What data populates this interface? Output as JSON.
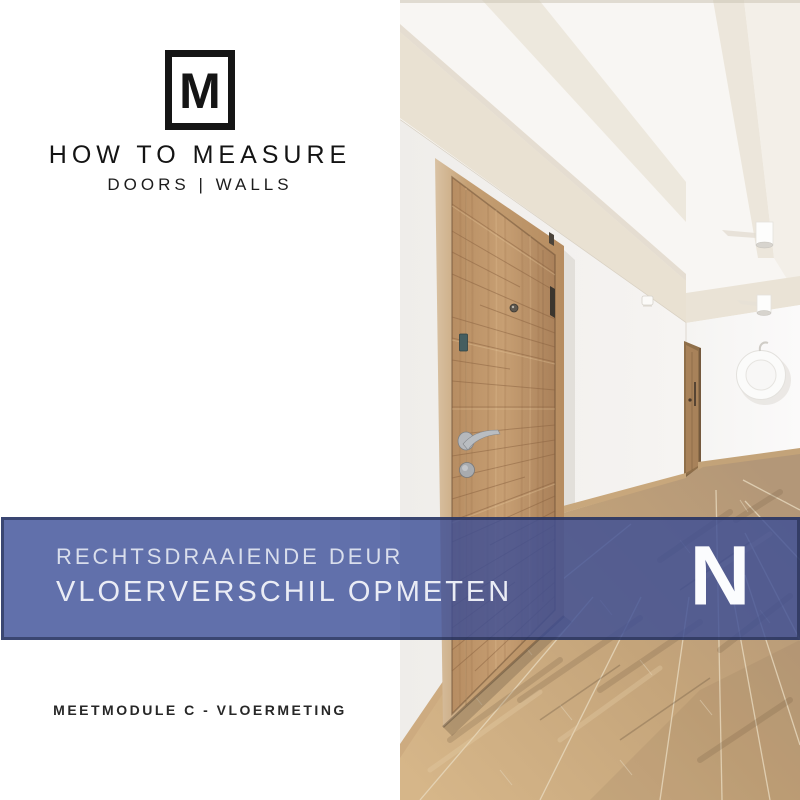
{
  "brand": {
    "monogram": "M",
    "title": "HOW TO MEASURE",
    "subtitle": "DOORS | WALLS"
  },
  "banner": {
    "line1": "RECHTSDRAAIENDE DEUR",
    "line2": "VLOERVERSCHIL OPMETEN",
    "badge_letter": "N"
  },
  "footer": {
    "module_label": "MEETMODULE C - VLOERMETING"
  },
  "photo": {
    "alt": "Hallway with a wooden entrance door, wooden plank floor, white walls and a round white ring ornament on the far wall"
  },
  "colors": {
    "banner_fill": "#3a4c96",
    "banner_border": "#1c2444",
    "banner_text": "#e9ecf5",
    "badge_letter_color": "#fbfcfe",
    "brand_text": "#141414"
  }
}
